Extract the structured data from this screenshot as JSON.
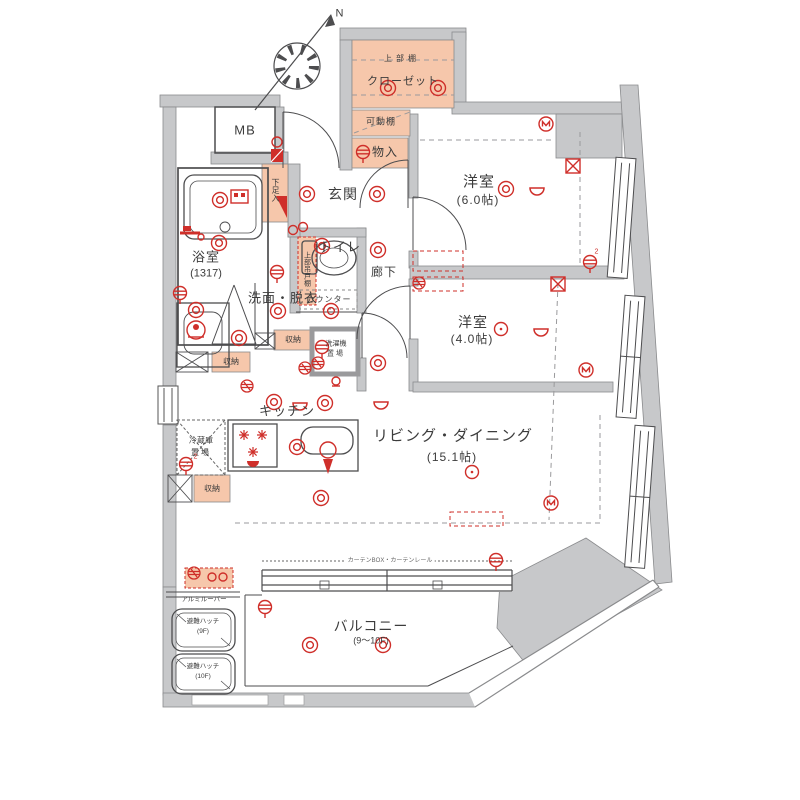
{
  "labels": {
    "mb": "MB",
    "north": "N",
    "upper_shelf": "上部棚",
    "closet": "クローゼット",
    "movable_shelf": "可動棚",
    "storage_in": "物入",
    "entrance": "玄関",
    "shoe_box": "下足入",
    "room6_name": "洋室",
    "room6_size": "(6.0帖)",
    "toilet": "トイレ",
    "toilet_upper_cabinet": "上部吊戸棚",
    "counter": "カウンター",
    "bath_name": "浴室",
    "bath_size": "(1317)",
    "corridor": "廊下",
    "washroom": "洗面・脱衣",
    "room4_name": "洋室",
    "room4_size": "(4.0帖)",
    "kitchen": "キッチン",
    "washer_l1": "洗濯機",
    "washer_l2": "置場",
    "fridge_l1": "冷蔵庫",
    "fridge_l2": "置場",
    "storage_a": "収納",
    "storage_b": "収納",
    "storage_c": "収納",
    "living_name": "リビング・ダイニング",
    "living_size": "(15.1帖)",
    "balcony_name": "バルコニー",
    "balcony_size": "(9〜10F)",
    "hatch9_l1": "避難ハッチ",
    "hatch9_l2": "(9F)",
    "hatch10_l1": "避難ハッチ",
    "hatch10_l2": "(10F)",
    "louver": "アルミルーバー",
    "curtain": "カーテンBOX・カーテンレール",
    "circuit": "2"
  },
  "colors": {
    "wall_gray": "#c7c8ca",
    "accent_salmon": "#f6c7ab",
    "symbol_red": "#cf2f2a",
    "line_dark": "#555555"
  }
}
